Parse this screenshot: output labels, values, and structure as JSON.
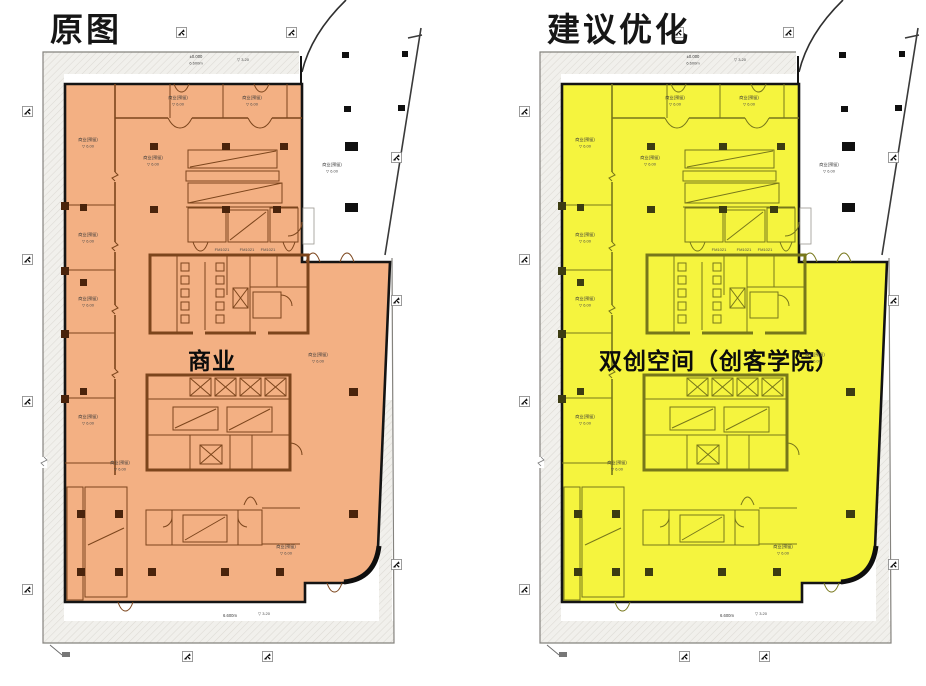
{
  "page": {
    "bg": "#ffffff"
  },
  "colors": {
    "site_line": "#85837e",
    "band_fill": "#f1f0ec",
    "band_hatch": "#dcdad4",
    "building_outline": "#141414",
    "black_square": "#101010"
  },
  "panels": [
    {
      "id": "original",
      "title": "原图",
      "zone_label": "商业",
      "zone_label_x": "212",
      "highlight": "#f3b083",
      "wall": "#7c451c",
      "wall_light": "#a86a35",
      "column": "#4a240c",
      "hatch_strip": "#c98b53"
    },
    {
      "id": "proposed",
      "title": "建议优化",
      "zone_label": "双创空间（创客学院）",
      "zone_label_x": "222",
      "highlight": "#f5f43e",
      "wall": "#77771b",
      "wall_light": "#a3a32e",
      "column": "#3c3c12",
      "hatch_strip": "#cfcf45"
    }
  ],
  "micro": {
    "room_label": "商业(预留)",
    "level_label": "▽ 6.00",
    "small_tag": "FM1021",
    "site_note_line1": "±0.000",
    "site_note_line2": "6.600m",
    "site_level": "▽ 3.20"
  }
}
